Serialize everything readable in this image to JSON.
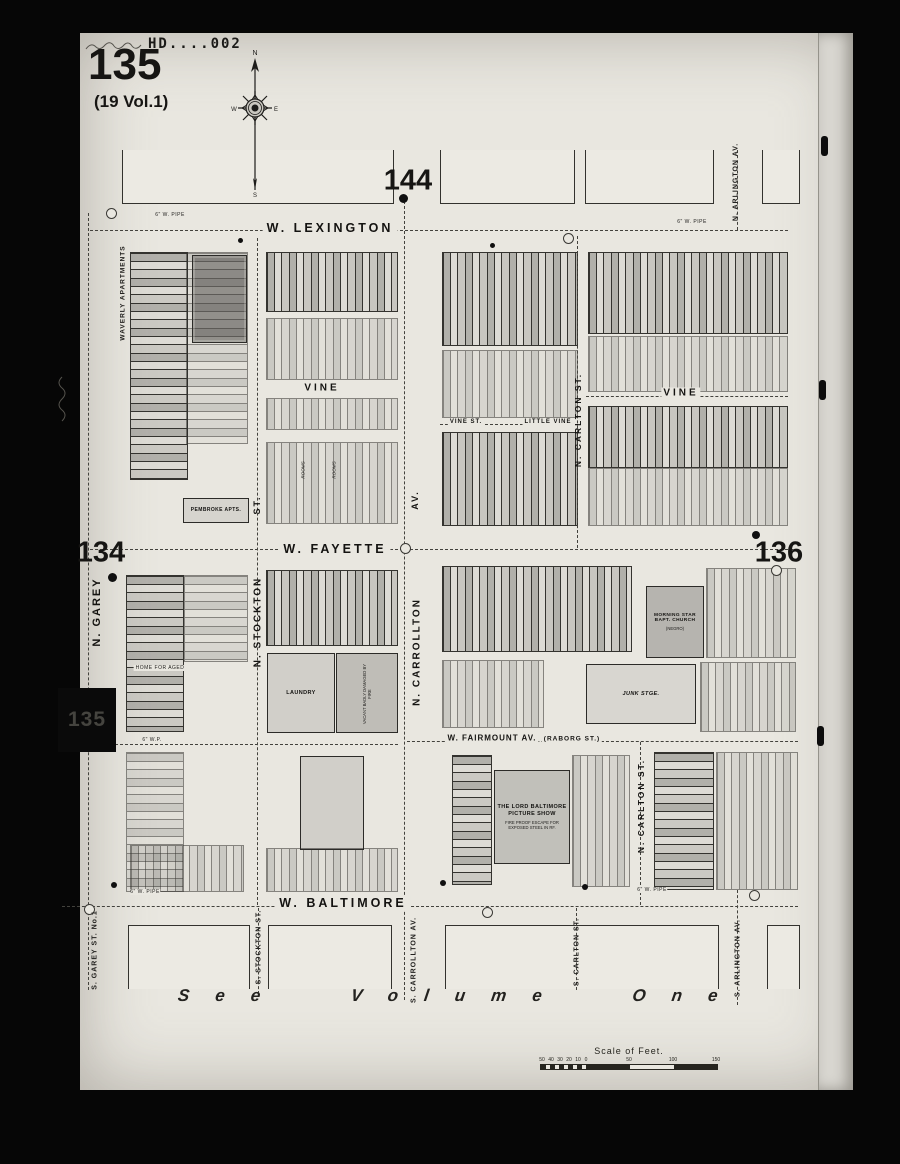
{
  "sheet": {
    "plate_number": "135",
    "volume_note": "(19 Vol.1)",
    "stamp": "HD....002",
    "tab_plate_number": "135",
    "adjacent": {
      "top": "144",
      "left": "134",
      "right": "136"
    },
    "footer_note": "See Volume One"
  },
  "compass": {
    "north": "N",
    "south": "S",
    "east": "E",
    "west": "W"
  },
  "streets": {
    "w_lexington": "W. LEXINGTON",
    "vine_left": "VINE",
    "vine_mid": "VINE ST.",
    "little_vine": "LITTLE VINE",
    "vine_right": "VINE",
    "w_fayette": "W. FAYETTE",
    "w_fairmount": "W. FAIRMOUNT AV.",
    "raborg": "(RABORG ST.)",
    "w_baltimore": "W. BALTIMORE",
    "n_garey": "N. GAREY",
    "n_stockton_abbr": "ST.",
    "n_stockton": "N. STOCKTON",
    "n_carrollton_abbr": "AV.",
    "n_carrollton": "N. CARROLLTON",
    "n_carlton_upper": "N. CARLTON ST.",
    "n_carlton_lower": "N. CARLTON ST.",
    "n_arlington": "N. ARLINGTON AV.",
    "s_garey": "S. GAREY ST. No.1",
    "s_stockton": "S. STOCKTON ST.",
    "s_carrollton": "S. CARROLLTON AV.",
    "s_carlton": "S. CARLTON ST.",
    "s_arlington": "S. ARLINGTON AV."
  },
  "buildings": {
    "waverly": "WAVERLY APARTMENTS",
    "pembroke": "PEMBROKE APTS.",
    "home_for_aged": "HOME FOR AGED",
    "rooms_1": "ROOMS",
    "rooms_2": "ROOMS",
    "laundry": "LAUNDRY",
    "vacant_note": "VACANT BADLY DAMAGED BY FIRE",
    "junk": "JUNK STGE.",
    "church_line1": "MORNING STAR",
    "church_line2": "BAPT. CHURCH",
    "church_line3": "(NEGRO)",
    "theatre_line1": "THE LORD BALTIMORE",
    "theatre_line2": "PICTURE SHOW",
    "theatre_note": "FIRE PROOF ESCAPE FOR EXPOSED STEEL IN RF."
  },
  "annotations": {
    "pipe_lexington_left": "6\" W. PIPE",
    "pipe_lexington_right": "6\" W. PIPE",
    "pipe_alley": "6\" W.P.",
    "pipe_baltimore_left": "6\" W. PIPE",
    "pipe_baltimore_right": "6\" W. PIPE"
  },
  "scale": {
    "title": "Scale of Feet.",
    "ticks_left": [
      "50",
      "40",
      "30",
      "20",
      "10",
      "0"
    ],
    "ticks_right": [
      "50",
      "100",
      "150"
    ]
  }
}
